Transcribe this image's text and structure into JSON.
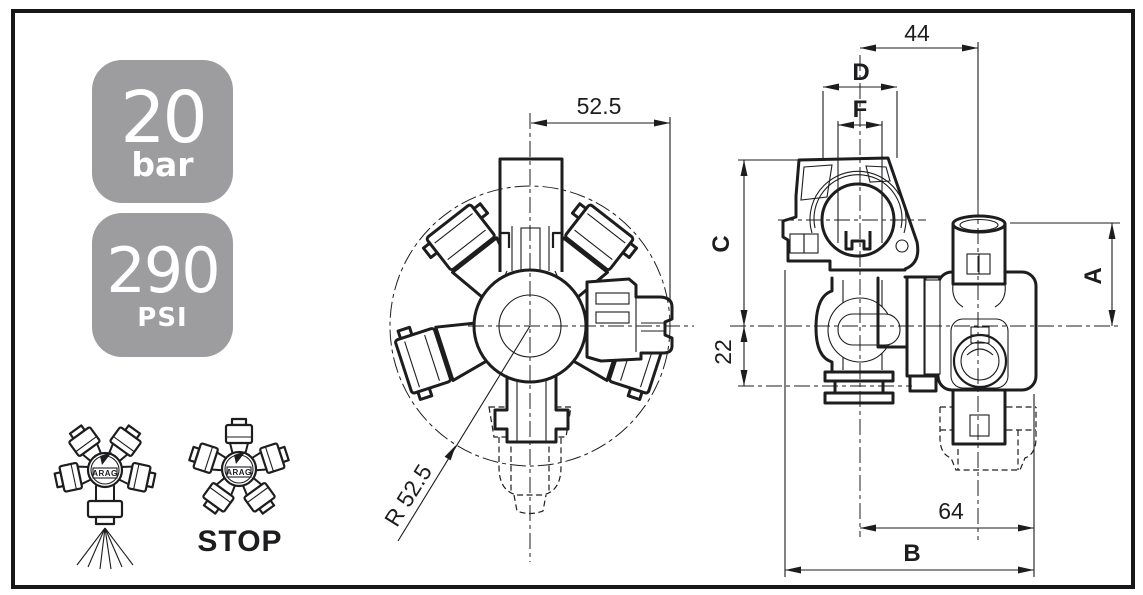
{
  "pressure_badges": [
    {
      "value": "20",
      "unit": "bar"
    },
    {
      "value": "290",
      "unit": "PSI"
    }
  ],
  "front_view": {
    "width_dim": "52.5",
    "radius_dim": "R 52.5"
  },
  "side_view": {
    "top_width": "44",
    "clamp_width": "D",
    "slot_width": "F",
    "upper_height": "C",
    "lower_height": "22",
    "port_height": "A",
    "lower_width": "64",
    "total_width": "B"
  },
  "legend_icons": {
    "spray_brand": "ARAG",
    "stop_brand": "ARAG",
    "stop_label": "STOP"
  },
  "colors": {
    "line": "#1d1d1f",
    "badge_gray": "#9d9da0",
    "badge_text": "#ffffff",
    "background": "#ffffff"
  }
}
